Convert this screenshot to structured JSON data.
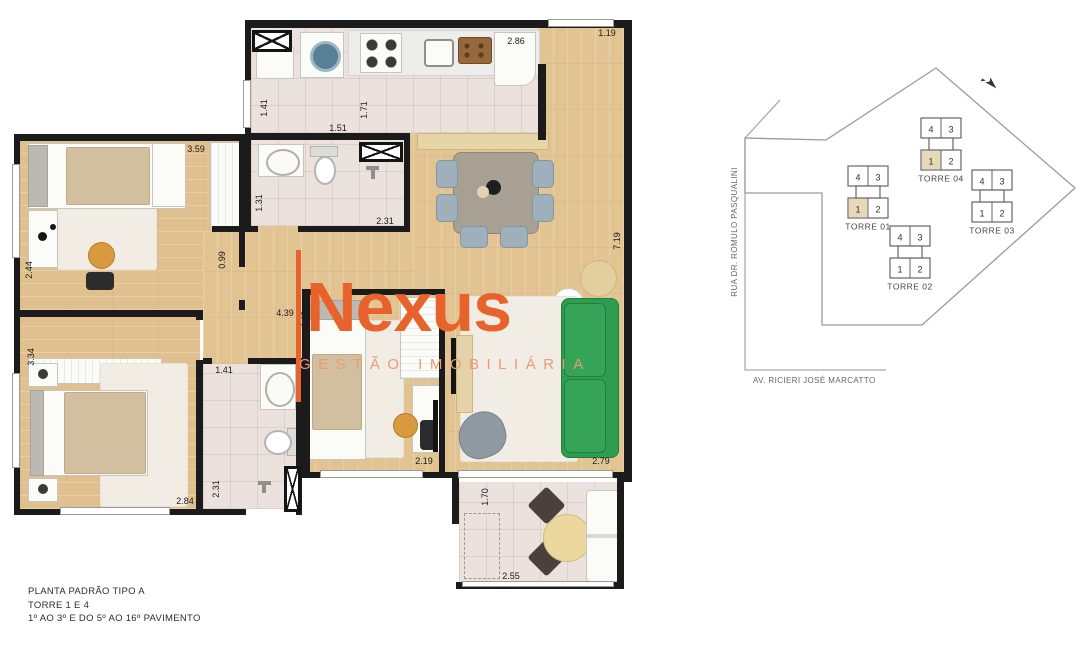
{
  "logo": {
    "brand": "Nexus",
    "subtitle": "GESTÃO IMOBILIÁRIA"
  },
  "footer": {
    "line1": "PLANTA  PADRÃO TIPO A",
    "line2": "TORRE 1 E 4",
    "line3": "1º AO 3º E DO 5º AO 16º PAVIMENTO"
  },
  "dims": {
    "entry_width": "1.19",
    "kitchen_width": "2.86",
    "laundry_depth": "1.41",
    "laundry_width": "1.51",
    "kitchen_depth": "1.71",
    "bedroom1_width": "3.59",
    "bath1_depth": "1.31",
    "bath1_width": "2.31",
    "hall_width": "0.99",
    "bedroom1_depth": "2.44",
    "living_length": "7.19",
    "hall_length": "4.39",
    "hall_depth": "2.74",
    "bedroom2_depth": "3.34",
    "bath2_width": "1.41",
    "bath2_depth": "2.31",
    "bedroom2_width": "2.84",
    "bedroom3_width": "2.19",
    "living_width": "2.79",
    "balcony_depth": "1.70",
    "balcony_width": "2.55"
  },
  "site_plan": {
    "street_left": "RUA DR. ROMULO PASQUALINI",
    "street_bottom": "AV. RICIERI JOSÉ MARCATTO",
    "towers": [
      {
        "label": "TORRE 04",
        "units": [
          "4",
          "3",
          "1",
          "2"
        ],
        "highlighted_unit": "1"
      },
      {
        "label": "TORRE 01",
        "units": [
          "4",
          "3",
          "1",
          "2"
        ],
        "highlighted_unit": "1"
      },
      {
        "label": "TORRE 03",
        "units": [
          "4",
          "3",
          "1",
          "2"
        ],
        "highlighted_unit": null
      },
      {
        "label": "TORRE 02",
        "units": [
          "4",
          "3",
          "1",
          "2"
        ],
        "highlighted_unit": null
      }
    ]
  },
  "icons": {
    "north_arrow": "north-arrow"
  },
  "colors": {
    "accent_orange": "#e8632b",
    "accent_orange_light": "#eb9b72",
    "wood_floor": "#e2c392",
    "tile_floor": "#ebe1dd",
    "wall": "#1b1b1b",
    "sofa_green": "#2a9a4d",
    "furniture_gray": "#9fb0bc",
    "site_highlight": "#e7d9b8"
  }
}
